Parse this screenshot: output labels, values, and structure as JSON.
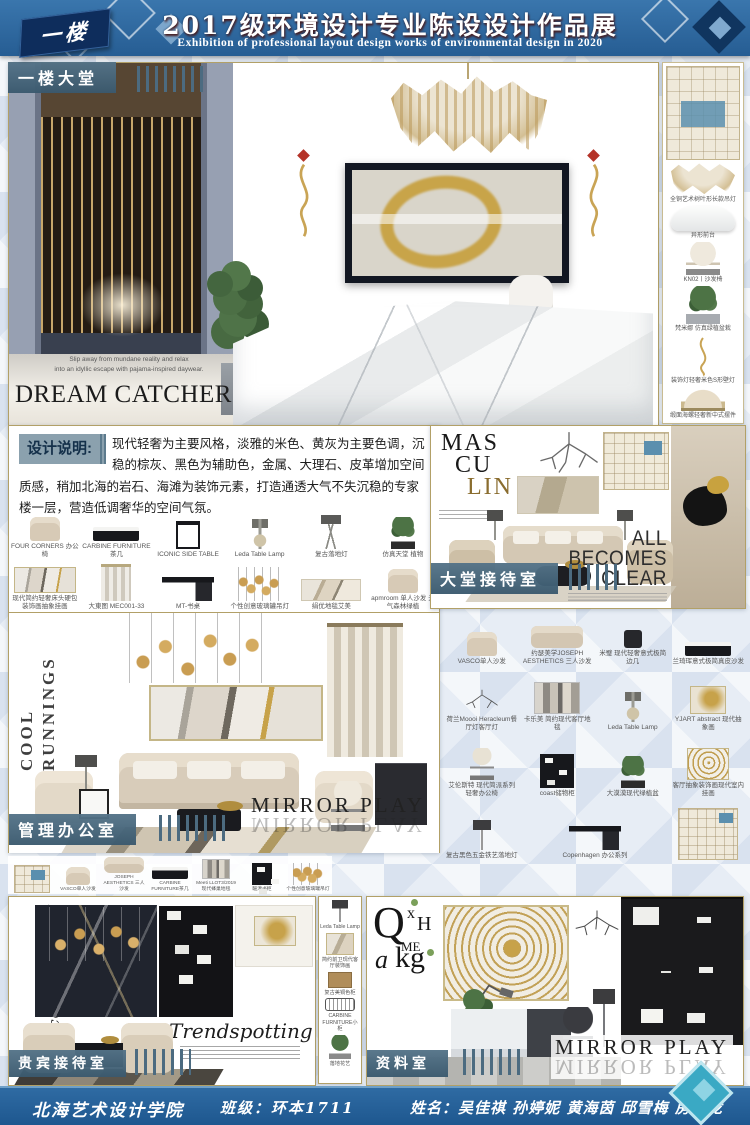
{
  "floor_badge": "一楼",
  "header": {
    "title": "2017级环境设计专业陈设设计作品展",
    "subtitle": "Exhibition of professional layout design works of environmental design in 2020"
  },
  "lobby": {
    "label": "一楼大堂",
    "tagline_line1": "Slip away from mundane reality and relax",
    "tagline_line2": "into an idyllic escape with pajama-inspired daywear.",
    "headline": "DREAM CATCHER"
  },
  "right_column": {
    "labels": [
      "全铜艺术树叶形长款吊灯",
      "异形前台",
      "KN02丨沙发椅",
      "梵米娜 仿真绿植盆栽",
      "装饰灯轻奢米色S形壁灯",
      "缎面海螺轻奢新中式摆件"
    ]
  },
  "design_note": {
    "label": "设计说明:",
    "text": "现代轻奢为主要风格，淡雅的米色、黄灰为主要色调，沉稳的棕灰、黑色为辅助色，金属、大理石、皮革增加空间质感，稍加北海的岩石、海滩为装饰元素，打造通透大气不失沉稳的专家楼一层，营造低调奢华的空间气氛。"
  },
  "lobby_products": {
    "row1": [
      "FOUR CORNERS 办公椅",
      "CARBINE FURNITURE茶几",
      "ICONIC SIDE TABLE",
      "Leda Table Lamp",
      "复古落地灯",
      "仿真天堂 植物"
    ],
    "row2": [
      "现代简约轻奢床头硬包装饰画抽象挂画",
      "大東图 MEC001-33",
      "MT-书桌",
      "个性创意玻璃罐吊灯",
      "绢优地毯艾美",
      "apmroom 单人沙发 元气森林绿植"
    ]
  },
  "reception": {
    "label": "大堂接待室",
    "deco_lines": [
      "MAS",
      "CU",
      "LIN"
    ],
    "clear_lines": [
      "ALL",
      "BECOMES",
      "CLEAR"
    ]
  },
  "office": {
    "label": "管理办公室",
    "vertical_line1": "COOL",
    "vertical_line2": "RUNNINGS",
    "mirror_text": "MIRROR PLAY"
  },
  "office_products": {
    "row1": [
      "VASCO单人沙发",
      "约瑟美学JOSEPH AESTHETICS 三人沙发",
      "米璧 现代轻奢意式极简边几",
      "兰琦珲意式极简真皮沙发"
    ],
    "row2": [
      "荷兰Moooi Heracleum餐厅灯客厅灯",
      "卡乐美 简约现代客厅地毯",
      "Leda Table Lamp",
      "YJART abstract 现代抽象画"
    ],
    "row3": [
      "艾伦斯特 现代简派系列轻奢办公椅",
      "coast储物柜",
      "大漠漠现代绿植盆",
      "客厅抽象装饰画现代室内挂画"
    ],
    "row4": [
      "复古黑色五金铁艺落地灯",
      "Copenhagen 办公系列"
    ]
  },
  "vip": {
    "label": "贵宾接待室",
    "script_text": "Trendspotting",
    "side_text": "Sección Personal"
  },
  "vip_products": [
    "VASCO单人沙发",
    "JOSEPH AESTHETICS 三人沙发",
    "CARBINE FURNITURE茶几",
    "Meeti LLOT3/2019 现代蜂巢地毯",
    "暖灌书柜",
    "个性创意玻璃罐吊灯"
  ],
  "strip_products": [
    "Leda Table Lamp",
    "简约前卫现代客厅装饰画",
    "复古美铜色柜",
    "CARBINE FURNITURE小柜",
    "落地花艺"
  ],
  "archive": {
    "label": "资料室",
    "mirror_text": "MIRROR PLAY",
    "letters": [
      "Q",
      "x",
      "H",
      "ME",
      "a",
      "kg"
    ]
  },
  "footer": {
    "school": "北海艺术设计学院",
    "class_text": "班级：环本1711",
    "names_text": "姓名：吴佳祺 孙婷妮 黄海茵 邱雪梅 房钊龙"
  }
}
